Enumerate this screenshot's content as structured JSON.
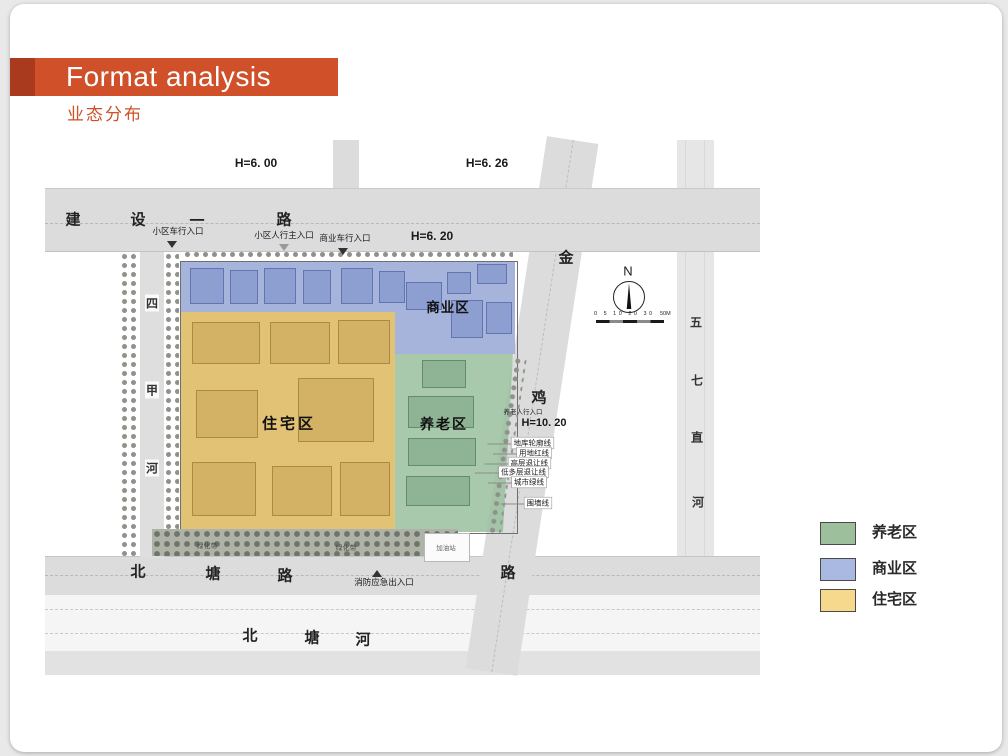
{
  "header": {
    "title": "Format analysis",
    "subtitle": "业态分布"
  },
  "map": {
    "elevations": {
      "h1": "H=6. 00",
      "h2": "H=6. 26",
      "h3": "H=6. 20",
      "h4": "H=10. 20"
    },
    "roads": {
      "jianshe": [
        "建",
        "设",
        "一",
        "路"
      ],
      "sijia": [
        "四",
        "甲",
        "河"
      ],
      "beitang_road": [
        "北",
        "塘",
        "路"
      ],
      "beitang_river": [
        "北",
        "塘",
        "河"
      ],
      "jinji": [
        "金",
        "鸡",
        "路"
      ],
      "wuqi": [
        "五",
        "七",
        "直",
        "河"
      ]
    },
    "zones": {
      "commercial": "商业区",
      "residential": "住宅区",
      "elderly": "养老区"
    },
    "entrances": {
      "community_vehicle": "小区车行入口",
      "community_pedestrian": "小区人行主入口",
      "commercial_vehicle": "商业车行入口",
      "elderly_pedestrian": "养老人行入口",
      "fire_emergency": "消防应急出入口"
    },
    "boundary_lines": [
      "地库轮廓线",
      "用地红线",
      "高层退让线",
      "低多层退让线",
      "城市绿线",
      "围墙线"
    ],
    "green_belt": "绿化带",
    "gas_station": "加油站",
    "north_label": "N",
    "scale_ticks": "0 5 10 20 30",
    "scale_max": "50M"
  },
  "legend": {
    "items": [
      {
        "label": "养老区",
        "color": "#9dbf9c"
      },
      {
        "label": "商业区",
        "color": "#aab9e1"
      },
      {
        "label": "住宅区",
        "color": "#f7d98e"
      }
    ]
  },
  "colors": {
    "accent": "#cf5029",
    "accent_dark": "#a93a1e",
    "zone_commercial": "#96a6d4",
    "zone_residential": "#ddb95e",
    "zone_elderly": "#9abf9f"
  }
}
